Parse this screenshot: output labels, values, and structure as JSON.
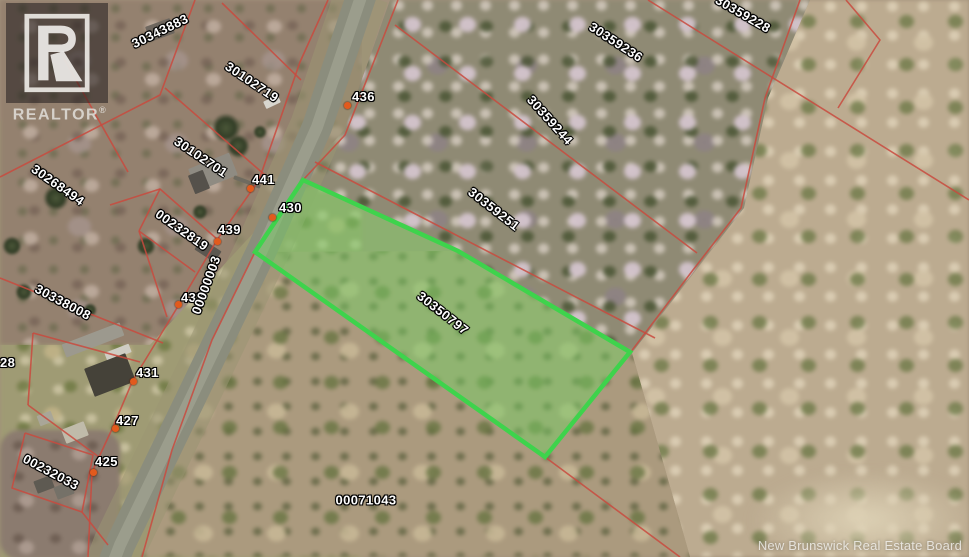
{
  "map": {
    "watermark": "New Brunswick Real Estate Board",
    "logo": {
      "letter": "R",
      "brand": "REALTOR",
      "registered": "®"
    },
    "colors": {
      "boundary": "#c94a3e",
      "highlight_border": "#3ed34c",
      "highlight_fill": "rgba(118,206,99,0.5)",
      "civic_dot": "#e25a1d",
      "label_text": "#ffffff"
    },
    "highlight_parcel": {
      "pid": "30350797",
      "points": "303,180 458,251 630,352 545,457 255,252"
    },
    "parcel_labels": [
      {
        "pid": "30343883",
        "x": 160,
        "y": 31,
        "rot": -26,
        "highlight": false
      },
      {
        "pid": "30102719",
        "x": 252,
        "y": 82,
        "rot": 34,
        "highlight": false
      },
      {
        "pid": "30102701",
        "x": 201,
        "y": 157,
        "rot": 34,
        "highlight": false
      },
      {
        "pid": "30268494",
        "x": 58,
        "y": 185,
        "rot": 35,
        "highlight": false
      },
      {
        "pid": "00232819",
        "x": 182,
        "y": 230,
        "rot": 35,
        "highlight": false
      },
      {
        "pid": "30338008",
        "x": 63,
        "y": 302,
        "rot": 28,
        "highlight": false
      },
      {
        "pid": "00232033",
        "x": 51,
        "y": 472,
        "rot": 28,
        "highlight": false
      },
      {
        "pid": "00000003",
        "x": 206,
        "y": 285,
        "rot": -70,
        "highlight": false
      },
      {
        "pid": "30359228",
        "x": 743,
        "y": 14,
        "rot": 30,
        "highlight": false
      },
      {
        "pid": "30359236",
        "x": 616,
        "y": 42,
        "rot": 33,
        "highlight": false
      },
      {
        "pid": "30359244",
        "x": 550,
        "y": 120,
        "rot": 48,
        "highlight": false
      },
      {
        "pid": "30359251",
        "x": 494,
        "y": 209,
        "rot": 38,
        "highlight": false
      },
      {
        "pid": "30350797",
        "x": 443,
        "y": 313,
        "rot": 38,
        "highlight": true
      },
      {
        "pid": "00071043",
        "x": 366,
        "y": 500,
        "rot": 0,
        "highlight": false
      }
    ],
    "civic_numbers": [
      {
        "num": "436",
        "x": 352,
        "y": 90,
        "dot": [
          347,
          105
        ]
      },
      {
        "num": "441",
        "x": 252,
        "y": 173,
        "dot": [
          250,
          188
        ]
      },
      {
        "num": "439",
        "x": 218,
        "y": 223,
        "dot": [
          217,
          241
        ]
      },
      {
        "num": "430",
        "x": 279,
        "y": 201,
        "dot": [
          272,
          217
        ]
      },
      {
        "num": "433",
        "x": 181,
        "y": 291,
        "dot": [
          178,
          304
        ]
      },
      {
        "num": "431",
        "x": 136,
        "y": 366,
        "dot": [
          133,
          381
        ]
      },
      {
        "num": "427",
        "x": 116,
        "y": 414,
        "dot": [
          115,
          428
        ]
      },
      {
        "num": "425",
        "x": 95,
        "y": 455,
        "dot": [
          93,
          472
        ]
      },
      {
        "num": "28",
        "x": 0,
        "y": 356,
        "dot": null
      }
    ],
    "boundaries": [
      {
        "points": "195,0 160,95 0,177"
      },
      {
        "points": "222,3 301,80"
      },
      {
        "points": "165,88 265,175"
      },
      {
        "points": "110,205 160,189 217,239"
      },
      {
        "points": "160,189 139,231"
      },
      {
        "points": "139,231 195,272"
      },
      {
        "points": "139,231 167,317"
      },
      {
        "points": "0,278 163,343"
      },
      {
        "points": "33,333 140,362"
      },
      {
        "points": "33,333 28,405"
      },
      {
        "points": "28,405 103,460"
      },
      {
        "points": "25,433 93,455 82,512 12,488 25,433"
      },
      {
        "points": "82,512 108,545"
      },
      {
        "points": "328,0 300,62 259,180 217,240 180,303 133,380 113,427 92,472 88,557"
      },
      {
        "points": "398,0 345,135 303,180"
      },
      {
        "points": "255,252 212,340 172,450 142,557"
      },
      {
        "points": "63,57 128,172"
      },
      {
        "points": "800,0 765,98 741,208 693,270 630,353"
      },
      {
        "points": "846,0 880,40 838,108"
      },
      {
        "points": "648,0 969,200"
      },
      {
        "points": "395,25 697,253"
      },
      {
        "points": "315,162 655,338"
      },
      {
        "points": "545,457 680,557"
      }
    ],
    "road": {
      "points": "362,-6 317,127 262,250 190,400 120,545 112,566"
    }
  }
}
